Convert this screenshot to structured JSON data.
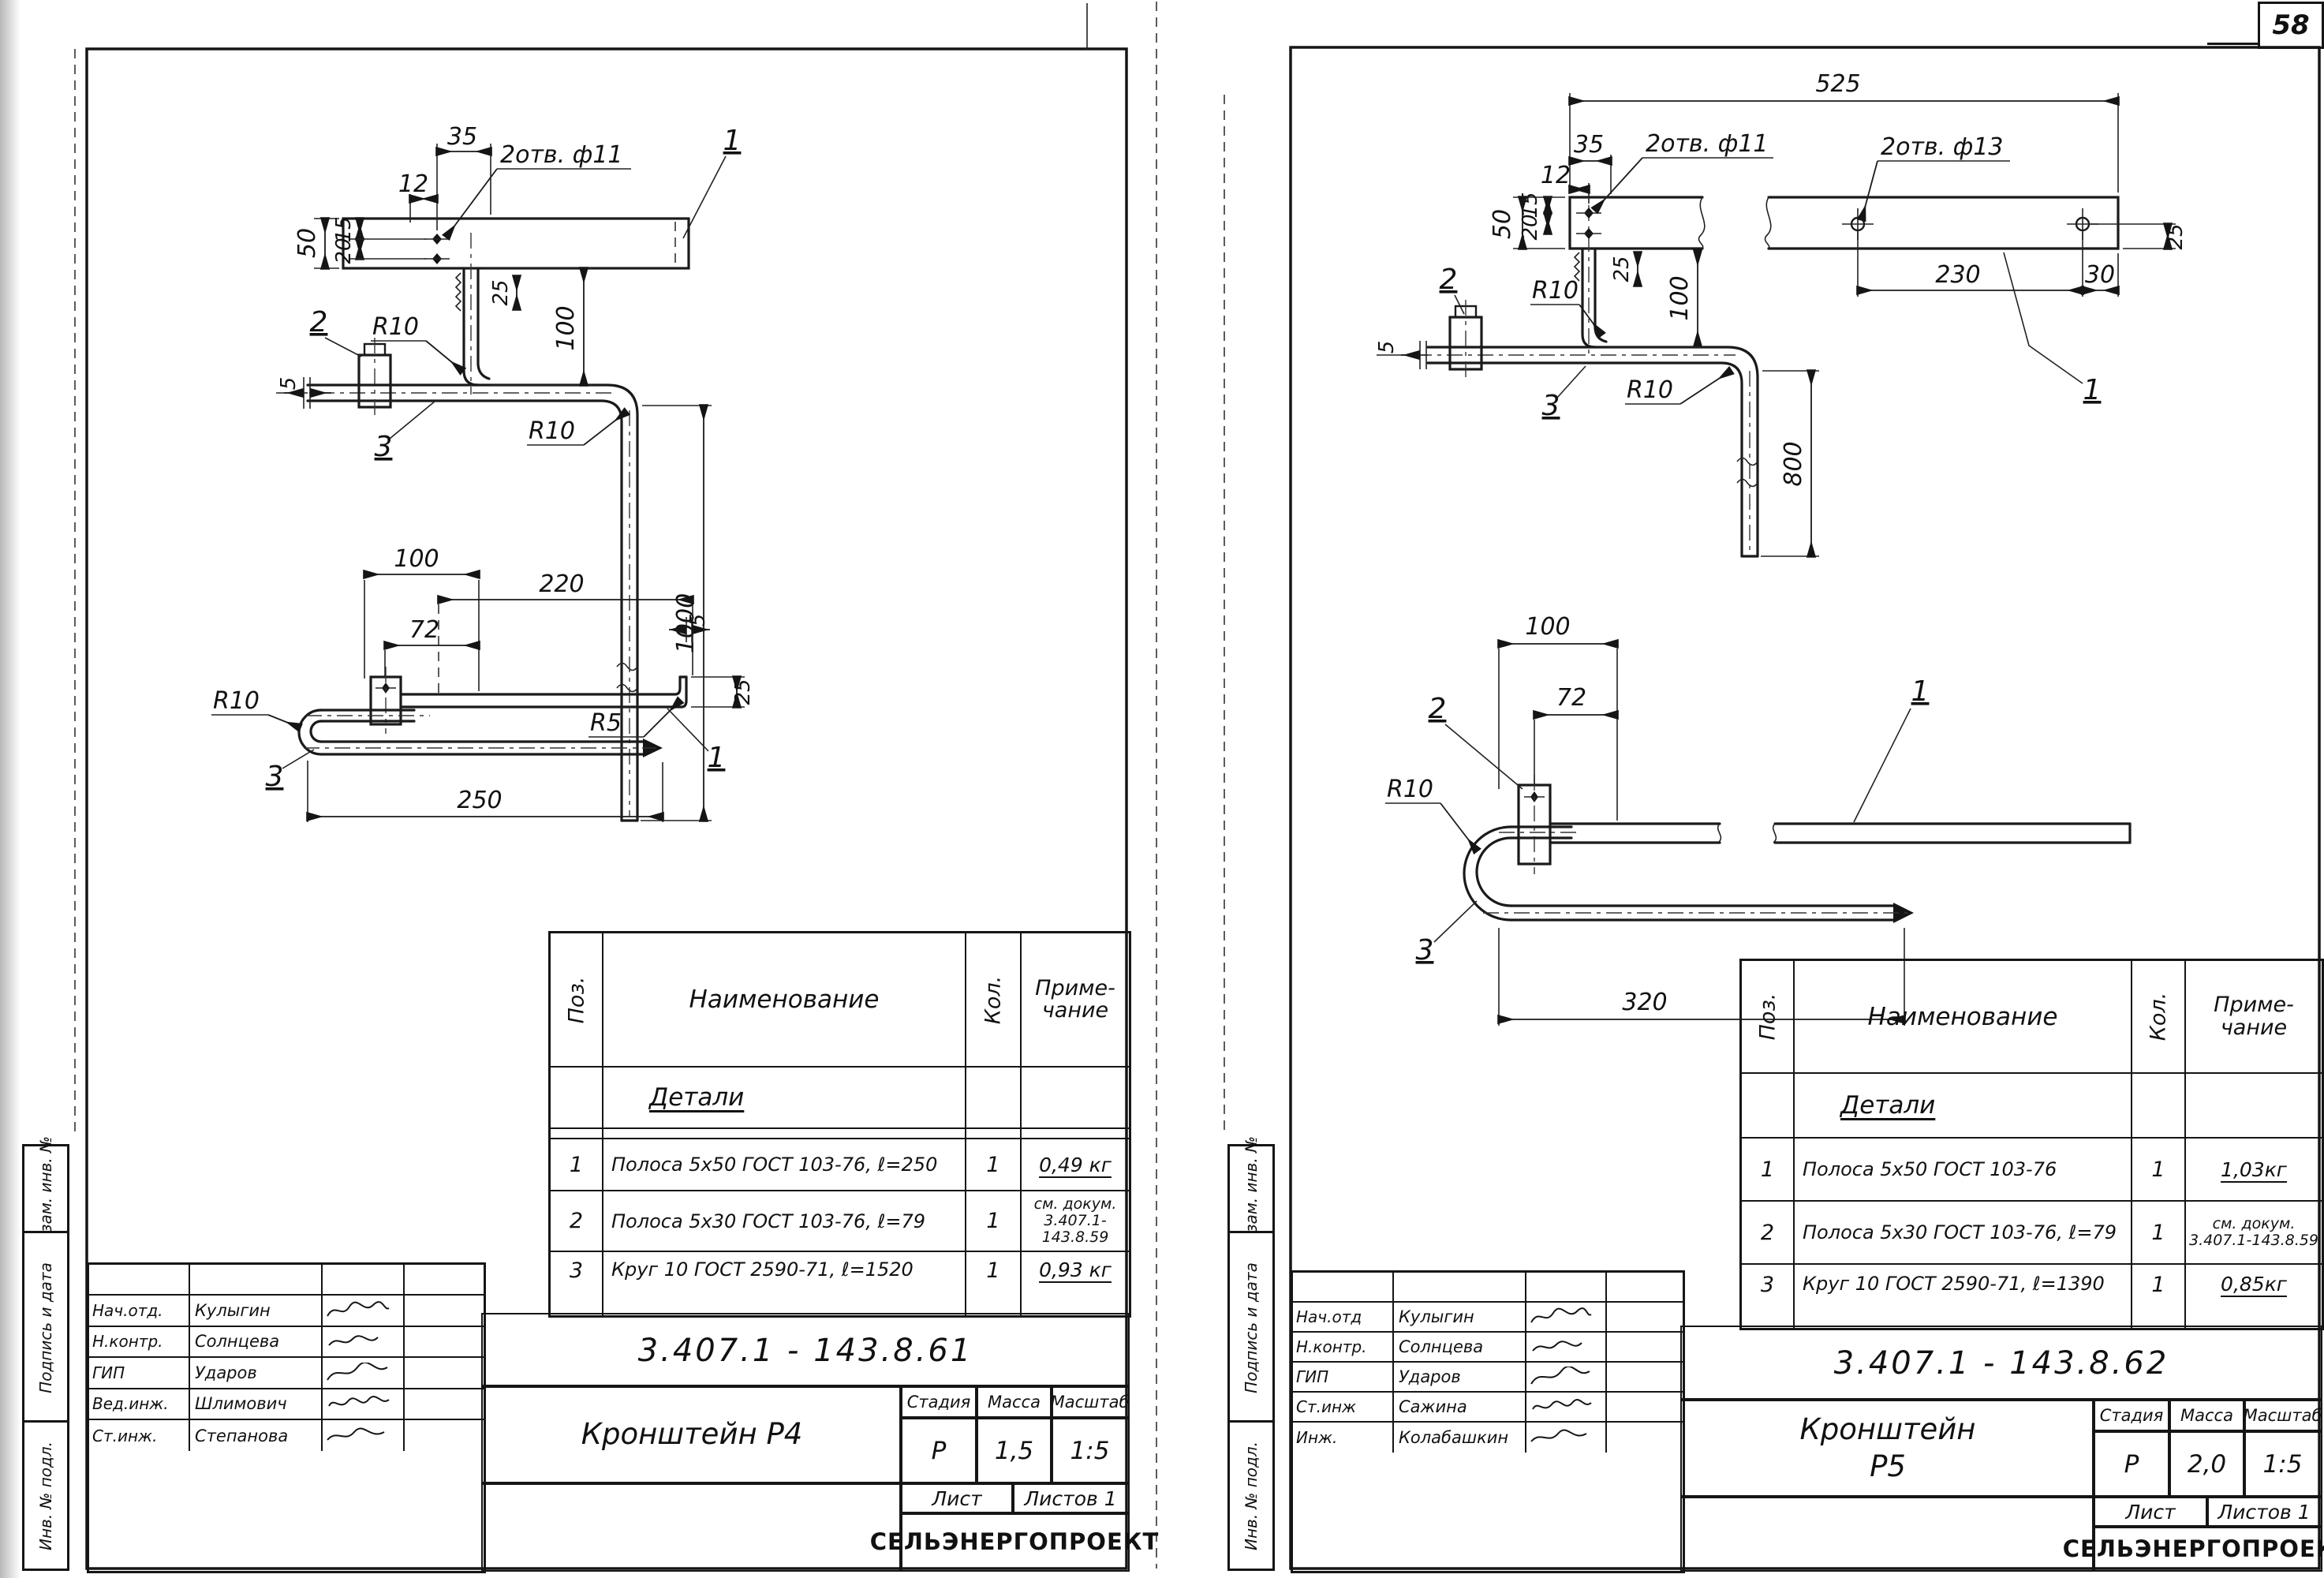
{
  "page": {
    "number": "58"
  },
  "stamps": {
    "vzam": "Взам. инв. №",
    "podpis": "Подпись и дата",
    "inv": "Инв. № подл."
  },
  "table_labels": {
    "pos": "Поз.",
    "name": "Наименование",
    "qty": "Кол.",
    "note1": "Приме-",
    "note2": "чание",
    "section": "Детали"
  },
  "tb": {
    "stage": "Стадия",
    "mass": "Масса",
    "scale": "Масштаб",
    "sheet": "Лист",
    "sheets": "Листов 1",
    "org": "СЕЛЬЭНЕРГОПРОЕКТ"
  },
  "left": {
    "doc": "3.407.1 - 143.8.61",
    "title": "Кронштейн Р4",
    "stage": "Р",
    "mass": "1,5",
    "scale": "1:5",
    "rows": [
      {
        "pos": "1",
        "name": "Полоса 5х50 ГОСТ 103-76, ℓ=250",
        "qty": "1",
        "note": "0,49 кг"
      },
      {
        "pos": "2",
        "name": "Полоса 5х30 ГОСТ 103-76, ℓ=79",
        "qty": "1",
        "note": "см. докум. 3.407.1-143.8.59"
      },
      {
        "pos": "3",
        "name": "Круг 10 ГОСТ 2590-71, ℓ=1520",
        "qty": "1",
        "note": "0,93 кг"
      }
    ],
    "sigs": [
      {
        "role": "Нач.отд.",
        "name": "Кулыгин"
      },
      {
        "role": "Н.контр.",
        "name": "Солнцева"
      },
      {
        "role": "ГИП",
        "name": "Ударов"
      },
      {
        "role": "Вед.инж.",
        "name": "Шлимович"
      },
      {
        "role": "Ст.инж.",
        "name": "Степанова"
      }
    ],
    "dims": {
      "d35": "35",
      "d12": "12",
      "holes11": "2отв. ф11",
      "p1": "1",
      "d50": "50",
      "d15": "15",
      "d20": "20",
      "d25a": "25",
      "d100a": "100",
      "r10a": "R10",
      "p2": "2",
      "d5a": "5",
      "p3": "3",
      "r10b": "R10",
      "d1000": "1000",
      "d100b": "100",
      "d220": "220",
      "d72": "72",
      "d5b": "5",
      "r5": "R5",
      "d25b": "25",
      "r10c": "R10",
      "p3b": "3",
      "p1b": "1",
      "d250": "250"
    }
  },
  "right": {
    "doc": "3.407.1 - 143.8.62",
    "title1": "Кронштейн",
    "title2": "Р5",
    "stage": "Р",
    "mass": "2,0",
    "scale": "1:5",
    "rows": [
      {
        "pos": "1",
        "name": "Полоса 5х50 ГОСТ 103-76",
        "qty": "1",
        "note": "1,03кг"
      },
      {
        "pos": "2",
        "name": "Полоса 5х30 ГОСТ 103-76, ℓ=79",
        "qty": "1",
        "note": "см. докум. 3.407.1-143.8.59"
      },
      {
        "pos": "3",
        "name": "Круг 10 ГОСТ 2590-71, ℓ=1390",
        "qty": "1",
        "note": "0,85кг"
      }
    ],
    "sigs": [
      {
        "role": "Нач.отд",
        "name": "Кулыгин"
      },
      {
        "role": "Н.контр.",
        "name": "Солнцева"
      },
      {
        "role": "ГИП",
        "name": "Ударов"
      },
      {
        "role": "Ст.инж",
        "name": "Сажина"
      },
      {
        "role": "Инж.",
        "name": "Колабашкин"
      }
    ],
    "dims": {
      "d525": "525",
      "d35": "35",
      "d12": "12",
      "d15": "15",
      "d50": "50",
      "d20": "20",
      "holes11": "2отв. ф11",
      "holes13": "2отв. ф13",
      "d25a": "25",
      "d100a": "100",
      "d230": "230",
      "d30": "30",
      "d25b": "25",
      "p1": "1",
      "r10a": "R10",
      "p2": "2",
      "d5": "5",
      "p3": "3",
      "r10b": "R10",
      "d800": "800",
      "d100b": "100",
      "d72": "72",
      "r10c": "R10",
      "p2b": "2",
      "p3b": "3",
      "p1b": "1",
      "d320": "320"
    }
  }
}
